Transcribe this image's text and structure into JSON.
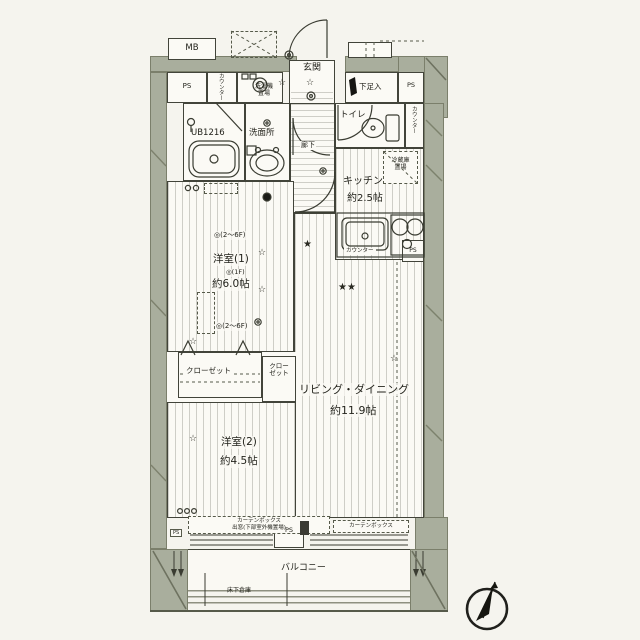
{
  "colors": {
    "wall": "#a9ae9d",
    "line": "#3b3d33",
    "paper": "#fbfaf5",
    "background": "#f5f4ee"
  },
  "labels": {
    "mb": "MB",
    "ps": "PS",
    "counter_vertical_left": "カウンター",
    "washer": "洗濯機\n置場",
    "entrance": "玄関",
    "shoe_cabinet": "下足入",
    "unit_bath": "UB1216",
    "washroom": "洗面所",
    "hallway": "廊下",
    "toilet": "トイレ",
    "counter_vertical_right": "カウンター",
    "fridge": "冷蔵庫\n置場",
    "kitchen_name": "キッチン",
    "kitchen_size": "約2.5帖",
    "counter_small": "カウンター",
    "room1_note_upper": "◎(2～6F)",
    "room1_name": "洋室(1)",
    "room1_note_1f": "◎(1F)",
    "room1_size": "約6.0帖",
    "room1_note_lower": "◎(2～6F)",
    "closet_main": "クローゼット",
    "closet_small": "クロー\nゼット",
    "living_name": "リビング・ダイニング",
    "living_size": "約11.9帖",
    "room2_name": "洋室(2)",
    "room2_size": "約4.5帖",
    "curtain_box_left": "カーテンボックス\n出窓(下部室外機置場)",
    "curtain_box_right": "カーテンボックス",
    "balcony": "バルコニー",
    "underfloor_storage": "床下倉庫"
  },
  "symbols": {
    "star_open": "☆",
    "star_filled": "★",
    "star_double": "★★"
  }
}
